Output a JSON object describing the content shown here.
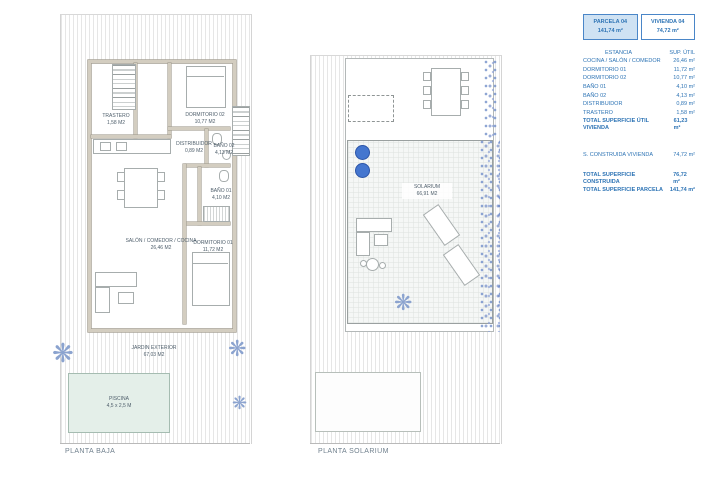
{
  "summary": {
    "header": {
      "parcela_label": "PARCELA 04",
      "parcela_area": "141,74 m²",
      "vivienda_label": "VIVIENDA 04",
      "vivienda_area": "74,72 m²"
    },
    "columns": {
      "estancia": "ESTANCIA",
      "sup": "SUP. ÚTIL"
    },
    "rows": [
      {
        "label": "COCINA / SALÓN / COMEDOR",
        "value": "26,46 m²"
      },
      {
        "label": "DORMITORIO 01",
        "value": "11,72 m²"
      },
      {
        "label": "DORMITORIO 02",
        "value": "10,77 m²"
      },
      {
        "label": "BAÑO 01",
        "value": "4,10 m²"
      },
      {
        "label": "BAÑO 02",
        "value": "4,13 m²"
      },
      {
        "label": "DISTRIBUIDOR",
        "value": "0,89 m²"
      },
      {
        "label": "TRASTERO",
        "value": "1,58 m²"
      }
    ],
    "total_util": {
      "label": "TOTAL SUPERFICIE ÚTIL VIVIENDA",
      "value": "61,23 m²"
    },
    "construida": {
      "label": "S. CONSTRUIDA VIVIENDA",
      "value": "74,72 m²"
    },
    "total_construida": {
      "label": "TOTAL SUPERFICIE CONSTRUIDA",
      "value": "76,72 m²"
    },
    "total_parcela": {
      "label": "TOTAL SUPERFICIE PARCELA",
      "value": "141,74 m²"
    }
  },
  "planta_baja": {
    "title": "PLANTA BAJA",
    "rooms": [
      {
        "name": "TRASTERO",
        "area": "1,58 M2"
      },
      {
        "name": "DORMITORIO 02",
        "area": "10,77 M2"
      },
      {
        "name": "DISTRIBUIDOR",
        "area": "0,89 M2"
      },
      {
        "name": "BAÑO 02",
        "area": "4,13 M2"
      },
      {
        "name": "BAÑO 01",
        "area": "4,10 M2"
      },
      {
        "name": "SALÓN / COMEDOR / COCINA",
        "area": "26,46 M2"
      },
      {
        "name": "DORMITORIO 01",
        "area": "11,72 M2"
      },
      {
        "name": "JARDIN EXTERIOR",
        "area": "67,03 M2"
      }
    ],
    "pool": {
      "name": "PISCINA",
      "dims": "4,5 x 2,5 M"
    }
  },
  "planta_solarium": {
    "title": "PLANTA SOLARIUM",
    "solarium": {
      "name": "SOLARIUM",
      "area": "66,91 M2"
    }
  },
  "icons": {
    "plant_glyph": "❋"
  }
}
